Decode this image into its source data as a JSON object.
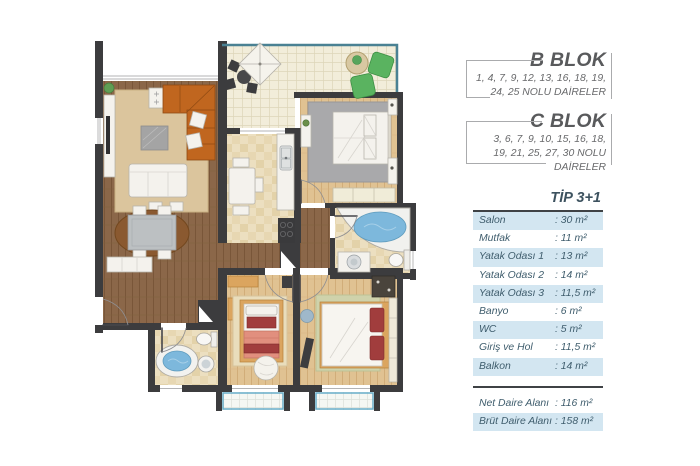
{
  "panel": {
    "blocks": [
      {
        "name": "B BLOK",
        "units_lines": [
          "1, 4, 7, 9, 12, 13, 16, 18, 19,",
          "24, 25 NOLU DAİRELER"
        ]
      },
      {
        "name": "C BLOK",
        "units_lines": [
          "3, 6, 7, 9, 10, 15, 16, 18,",
          "19, 21, 25, 27, 30 NOLU",
          "DAİRELER"
        ]
      }
    ],
    "type_table": {
      "title": "TİP 3+1",
      "rows": [
        {
          "label": "Salon",
          "value": ": 30 m²"
        },
        {
          "label": "Mutfak",
          "value": ": 11 m²"
        },
        {
          "label": "Yatak Odası 1",
          "value": ": 13 m²"
        },
        {
          "label": "Yatak Odası 2",
          "value": ": 14 m²"
        },
        {
          "label": "Yatak Odası 3",
          "value": ": 11,5 m²"
        },
        {
          "label": "Banyo",
          "value": ": 6 m²"
        },
        {
          "label": "WC",
          "value": ": 5 m²"
        },
        {
          "label": "Giriş ve Hol",
          "value": ": 11,5 m²"
        },
        {
          "label": "Balkon",
          "value": ": 14 m²"
        }
      ],
      "totals": [
        {
          "label": "Net Daire Alanı",
          "value": ": 116 m²"
        },
        {
          "label": "Brüt Daire Alanı",
          "value": ": 158 m²"
        }
      ]
    }
  },
  "colors": {
    "accent_row_bg": "#d3e6f1",
    "table_text": "#3f5d6d",
    "heading_gray": "#595a5c",
    "units_gray": "#68696b",
    "rule_dark": "#3f4245",
    "bracket_gray": "#aaabad",
    "wall": "#3c3c3e",
    "water_blue": "#7db8dc",
    "sofa_orange": "#c0661f",
    "bed_red": "#a13d3d",
    "balcony_trim": "#68aec9"
  }
}
